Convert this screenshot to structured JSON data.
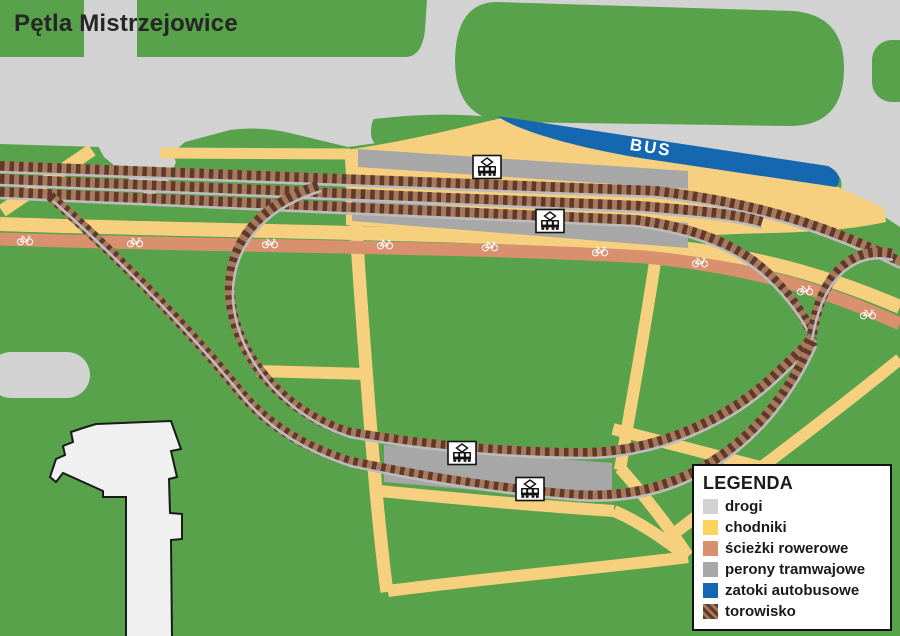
{
  "title": "Pętla Mistrzejowice",
  "map": {
    "bus_label": "BUS",
    "tram_stop_icons": 4,
    "bike_path_icons": 9,
    "colors": {
      "grass": "#57a24b",
      "road": "#d2d2d2",
      "sidewalk": "#f6d07f",
      "bike_path": "#d9906f",
      "platform": "#a7a7a7",
      "bus_bay": "#1568b0",
      "track_dark": "#5f392c",
      "track_light": "#a87a5c",
      "rail": "#bcbcbc",
      "building_fill": "#f0f0f0",
      "building_outline": "#1a1a1a",
      "bike_icon": "#ffffff",
      "bus_text": "#ffffff"
    }
  },
  "legend": {
    "title": "LEGENDA",
    "items": [
      {
        "id": "drogi",
        "label": "drogi",
        "color": "#d2d2d2"
      },
      {
        "id": "chodniki",
        "label": "chodniki",
        "color": "#fad45e"
      },
      {
        "id": "sciezki-rowerowe",
        "label": "ścieżki rowerowe",
        "color": "#d9906f"
      },
      {
        "id": "perony-tramwajowe",
        "label": "perony tramwajowe",
        "color": "#a7a7a7"
      },
      {
        "id": "zatoki-autobusowe",
        "label": "zatoki autobusowe",
        "color": "#1568b0"
      },
      {
        "id": "torowisko",
        "label": "torowisko",
        "color": "#5f392c",
        "color2": "#a87a5c",
        "striped": true
      }
    ]
  }
}
